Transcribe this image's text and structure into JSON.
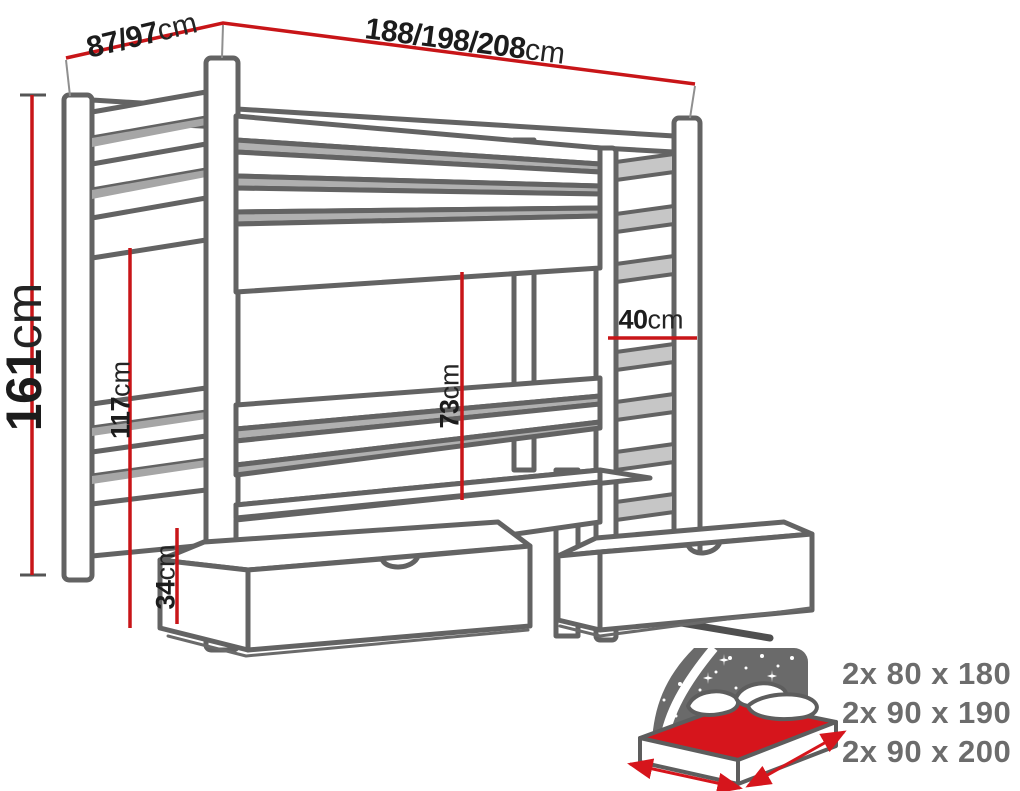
{
  "page": {
    "background": "#ffffff"
  },
  "colors": {
    "dimension_red": "#c81518",
    "label_black": "#1c1c1c",
    "outline_gray": "#636363",
    "shade_gray": "#b0b0b0",
    "sizes_text_gray": "#6c6c6c",
    "icon_panel_gray": "#6a6a6a",
    "mattress_red": "#d6151c"
  },
  "dimensions": {
    "end_width": {
      "value": "87/97",
      "unit": "cm"
    },
    "length": {
      "value": "188/198/208",
      "unit": "cm"
    },
    "total_height": {
      "value": "161",
      "unit": "cm"
    },
    "underside_height": {
      "value": "117",
      "unit": "cm"
    },
    "bunk_clearance": {
      "value": "73",
      "unit": "cm"
    },
    "ladder_width": {
      "value": "40",
      "unit": "cm"
    },
    "drawer_height": {
      "value": "34",
      "unit": "cm"
    }
  },
  "mattress_sizes": {
    "options": [
      "2x 80 x 180",
      "2x 90 x 190",
      "2x 90 x 200"
    ]
  }
}
